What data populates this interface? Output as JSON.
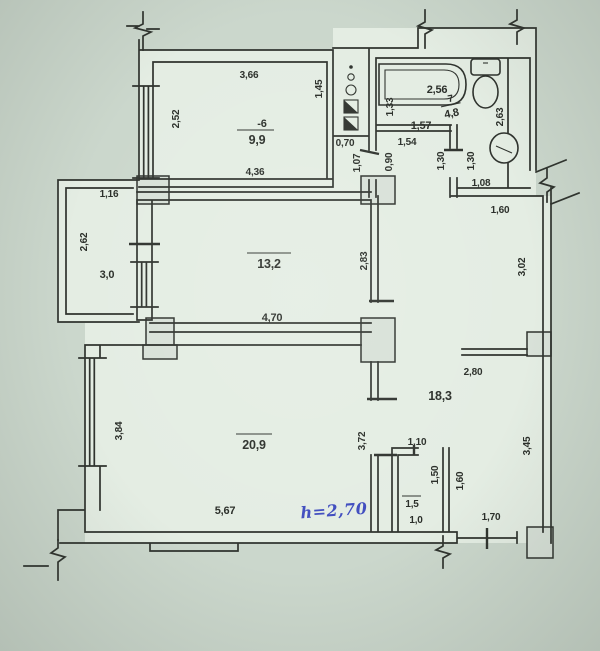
{
  "document": {
    "type": "scanned apartment floor plan",
    "units": "meters",
    "handwritten_note": "h=2,70"
  },
  "colors": {
    "paper": "#cbd7cc",
    "room_fill": "#e4ede3",
    "ink": "#2f332e",
    "pier_fill": "#d8e1d8",
    "handwriting_blue": "#3f4cbf"
  },
  "fixtures": [
    "bathtub",
    "toilet",
    "sink",
    "ventilation-shaft"
  ],
  "rooms": {
    "room6": {
      "number": "-6",
      "area": "9,9",
      "dim_top": "3,66",
      "dim_left": "2,52",
      "dim_right": "1,45",
      "dim_bottom": "4,36"
    },
    "duct_nook": {
      "dim_width": "0,70",
      "dim_height": "1,07"
    },
    "vestibule": {
      "dim_top": "1,54",
      "dim_door": "0,90"
    },
    "bathroom": {
      "number": "7",
      "area": "4,8",
      "tub_width": "2,56",
      "dim_left": "1,33",
      "dim_inner": "1,57",
      "dim_right": "2,63",
      "door_a": "1,30",
      "door_b": "1,30",
      "dim_bottom": "1,08"
    },
    "balcony": {
      "area": "3,0",
      "dim_top": "1,16",
      "dim_left": "2,62"
    },
    "room13": {
      "area": "13,2",
      "dim_right": "2,83",
      "dim_bottom": "4,70"
    },
    "hall": {
      "area": "18,3",
      "dim_top": "1,60",
      "dim_right_upper": "3,02",
      "dim_width": "2,80",
      "dim_right_lower": "3,45",
      "dim_closet_side": "1,60",
      "dim_entry": "1,70"
    },
    "closet": {
      "area": "1,5",
      "area_lower": "1,0",
      "dim_top": "1,10",
      "dim_inner": "1,50"
    },
    "room20": {
      "area": "20,9",
      "dim_left": "3,84",
      "dim_right": "3,72",
      "dim_bottom": "5,67",
      "height_note": "h=2,70"
    }
  }
}
